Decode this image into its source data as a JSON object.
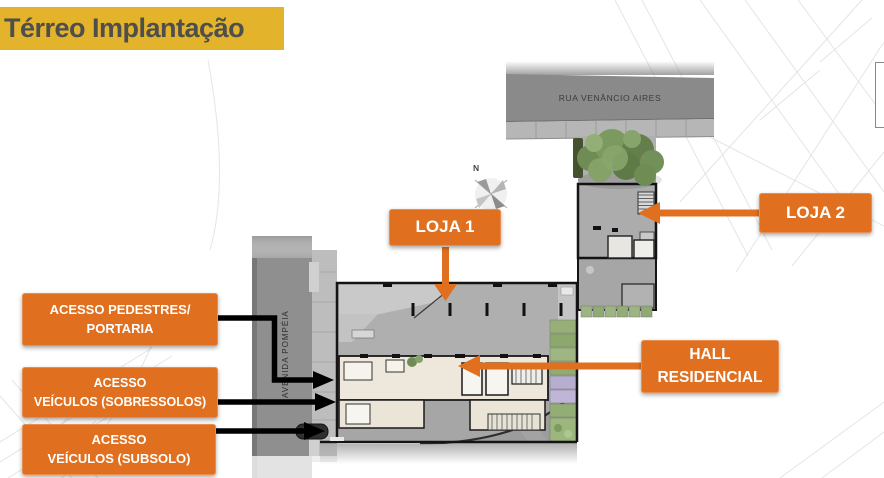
{
  "slide": {
    "title": "Térreo Implantação"
  },
  "callouts": {
    "loja1": {
      "label": "LOJA 1"
    },
    "loja2": {
      "label": "LOJA 2"
    },
    "pedestres": {
      "line1": "ACESSO PEDESTRES/",
      "line2": "PORTARIA"
    },
    "sobressolos": {
      "line1": "ACESSO",
      "line2": "VEÍCULOS (SOBRESSOLOS)"
    },
    "subsolo": {
      "line1": "ACESSO",
      "line2": "VEÍCULOS (SUBSOLO)"
    },
    "hall": {
      "line1": "HALL",
      "line2": "RESIDENCIAL"
    }
  },
  "plan": {
    "street_top": "RUA VENÂNCIO AIRES",
    "street_left": "AVENIDA POMPÉIA",
    "compass_label": "N"
  },
  "colors": {
    "accent_orange": "#E0701F",
    "banner_yellow": "#E2B32B",
    "title_text": "#4E4E4C",
    "callout_text": "#FFFFFF",
    "arrow_black": "#000000",
    "street_gray": "#8A8A8A",
    "floor_gray": "#AFAFAF",
    "core_beige": "#EDE8DB",
    "garden_green": "#96B077",
    "paver_purple": "#B7ADCE"
  }
}
